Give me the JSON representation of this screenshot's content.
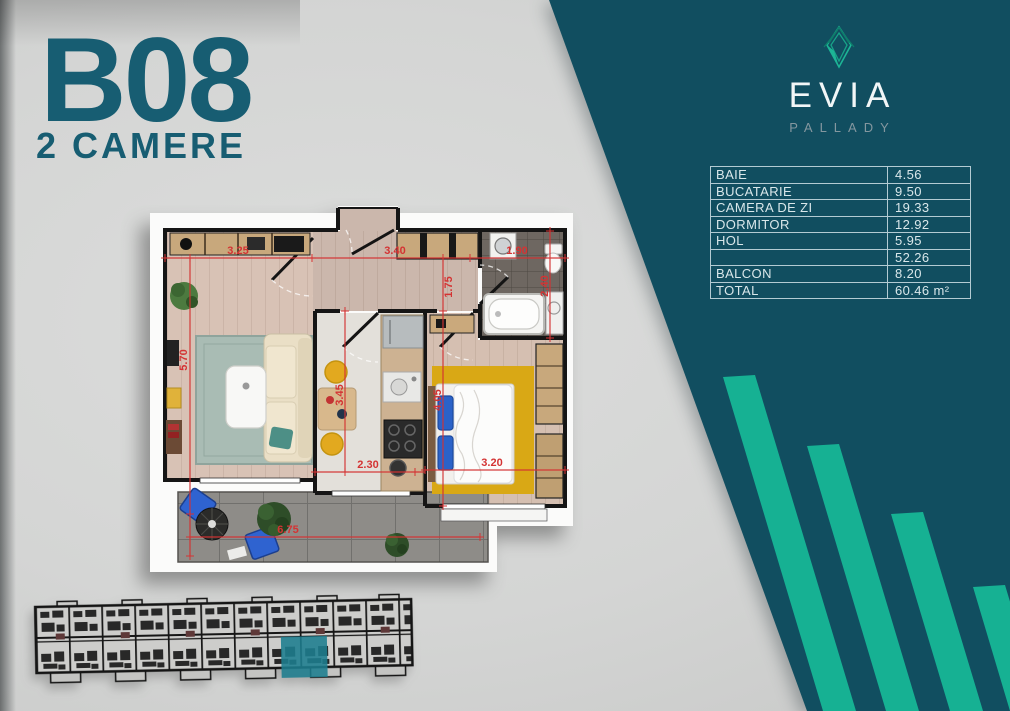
{
  "unit": {
    "code": "B08",
    "type": "2 CAMERE"
  },
  "brand": {
    "name": "EVIA",
    "location": "PALLADY"
  },
  "area_table": {
    "rows": [
      {
        "label": "BAIE",
        "value": "4.56"
      },
      {
        "label": "BUCATARIE",
        "value": "9.50"
      },
      {
        "label": "CAMERA DE ZI",
        "value": "19.33"
      },
      {
        "label": "DORMITOR",
        "value": "12.92"
      },
      {
        "label": "HOL",
        "value": "5.95"
      },
      {
        "label": "",
        "value": "52.26"
      },
      {
        "label": "BALCON",
        "value": "8.20"
      },
      {
        "label": "TOTAL",
        "value": "60.46 m²"
      }
    ]
  },
  "floorplan": {
    "dims": {
      "living_width": "3.25",
      "hall_width": "3.40",
      "bath_width": "1.90",
      "living_height": "5.70",
      "hall_height": "1.75",
      "bath_height": "2.40",
      "kitchen_width": "2.30",
      "bedroom_width": "3.20",
      "kitchen_height": "3.45",
      "bedroom_height": "4.05",
      "balcony_width": "6.75"
    }
  },
  "colors": {
    "panel_teal": "#114e60",
    "bar_green": "#16b193",
    "title_teal": "#175d72",
    "table_line": "#c9dade",
    "dim_red": "#d43333",
    "siteplan_highlight": "#1d7d8e"
  }
}
